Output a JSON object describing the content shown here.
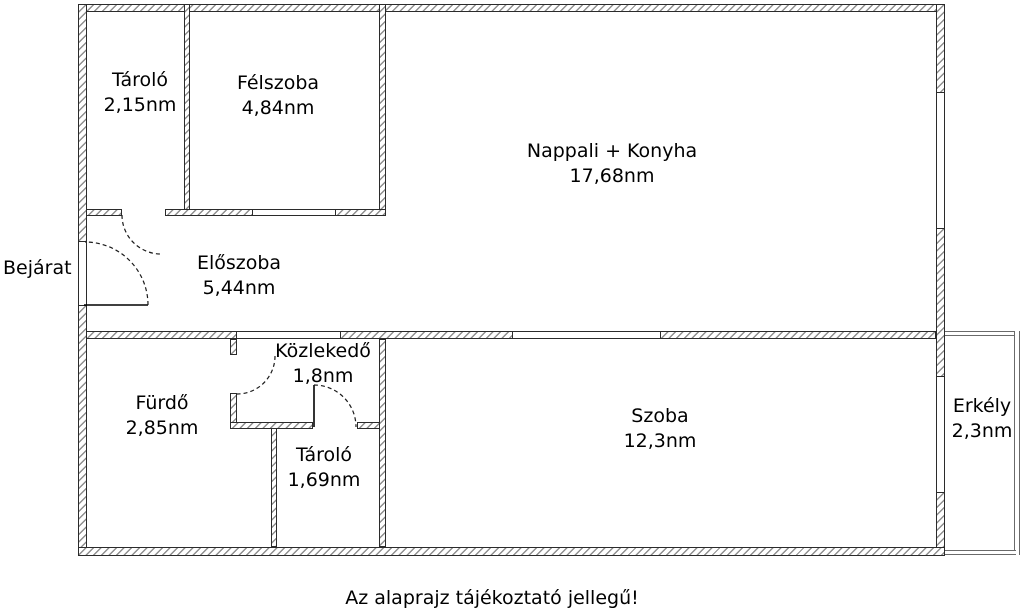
{
  "floorplan": {
    "entrance_label": "Bejárat",
    "footer_note": "Az alaprajz tájékoztató jellegű!",
    "rooms": {
      "tarolo_top": {
        "name": "Tároló",
        "area": "2,15nm"
      },
      "felszoba": {
        "name": "Félszoba",
        "area": "4,84nm"
      },
      "nappali_konyha": {
        "name": "Nappali + Konyha",
        "area": "17,68nm"
      },
      "eloszoba": {
        "name": "Előszoba",
        "area": "5,44nm"
      },
      "kozlekedo": {
        "name": "Közlekedő",
        "area": "1,8nm"
      },
      "furdo": {
        "name": "Fürdő",
        "area": "2,85nm"
      },
      "tarolo_bottom": {
        "name": "Tároló",
        "area": "1,69nm"
      },
      "szoba": {
        "name": "Szoba",
        "area": "12,3nm"
      },
      "erkely": {
        "name": "Erkély",
        "area": "2,3nm"
      }
    },
    "colors": {
      "background": "#ffffff",
      "wall_outline": "#2b2b2b",
      "wall_hatch": "#8f8f8f",
      "text": "#000000"
    }
  }
}
